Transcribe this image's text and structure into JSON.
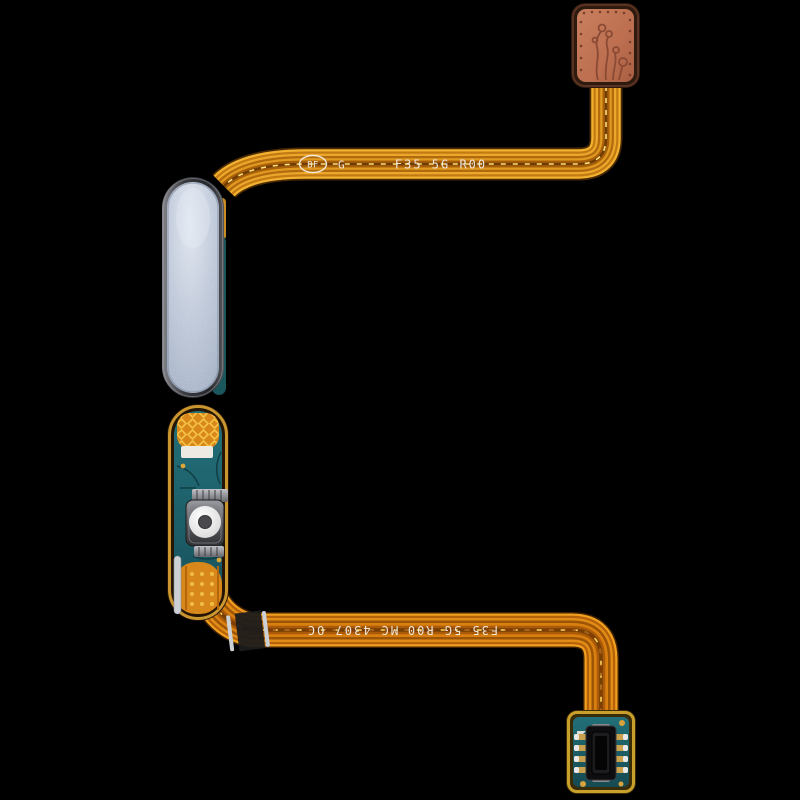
{
  "photo": {
    "subject": "Power / fingerprint button flex cable on black background",
    "background": "#000000"
  },
  "markings": {
    "top_cable": {
      "oval_mark": "BF",
      "grade_mark": "G",
      "model": "F35 5G R00"
    },
    "bottom_cable": {
      "model": "F35 5G R00",
      "batch": "MC 4307 OC"
    }
  },
  "colors": {
    "flex_gold": "#f2b12e",
    "flex_orange": "#e08c16",
    "pad_copper": "#c0765a",
    "pcb_teal": "#1d5f66",
    "button_blue": "#bcc6d7",
    "button_rim_gray": "#3a3b40",
    "switch_metal": "#6e6f74",
    "dome_white": "#ffffff",
    "connector_black": "#0e0e10",
    "marking_white": "#f5f2ea",
    "stiffener_black": "#1c1c1c",
    "solder_silver": "#ccd1d6"
  },
  "components": {
    "top_pad": "copper-contact-pad",
    "top_cable": "flex-ribbon-upper-run",
    "button": "blue-side-button-cap",
    "sensor_board": "sensor-board-with-dome-switch",
    "bottom_cable": "flex-ribbon-lower-run",
    "connector_board": "board-to-board-connector-pcb"
  }
}
